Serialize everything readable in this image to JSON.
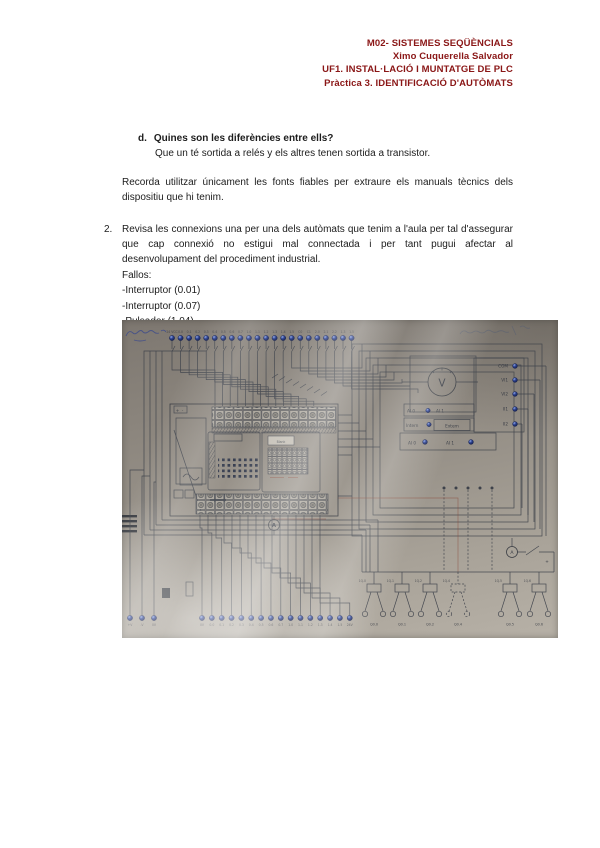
{
  "doc": {
    "header": {
      "lines": [
        "M02- SISTEMES SEQÜÈNCIALS",
        "Ximo Cuquerella Salvador",
        "UF1. INSTAL·LACIÓ I MUNTATGE DE PLC",
        "Pràctica 3. IDENTIFICACIÓ D'AUTÒMATS"
      ],
      "color": "#8a1616"
    },
    "item_d": {
      "label": "d.",
      "question": "Quines son les diferències entre ells?",
      "answer": "Que un té sortida a relés y els altres tenen sortida a transistor."
    },
    "note": "Recorda utilitzar únicament les fonts fiables per extraure els manuals tècnics dels dispositiu que hi tenim.",
    "item_2": {
      "label": "2.",
      "text": "Revisa les connexions una per una dels autòmats que tenim a l'aula per tal d'assegurar que cap connexió no estigui mal connectada i per tant pugui afectar al desenvolupament del procediment industrial.",
      "fallos_title": "Fallos:",
      "faults": [
        "-Interruptor (0.01)",
        "-Interruptor (0.07)",
        "-Pulsador (1.04)"
      ]
    }
  },
  "schematic": {
    "top_terminals": [
      "24 VCC",
      "0.0",
      "0.1",
      "0.2",
      "0.3",
      "0.4",
      "0.5",
      "0.6",
      "0.7",
      "1.0",
      "1.1",
      "1.2",
      "1.3",
      "1.4",
      "1.5",
      "C0",
      "C1",
      "2.0",
      "2.1",
      "2.2",
      "1.3",
      "1.5"
    ],
    "bottom_left_terminals": [
      "+V",
      "-V",
      "0V"
    ],
    "bottom_terminals": [
      "0V",
      "0.0",
      "0.1",
      "0.2",
      "0.3",
      "0.4",
      "0.5",
      "0.6",
      "0.7",
      "1.0",
      "1.1",
      "1.2",
      "1.3",
      "1.4",
      "1.5",
      "24V"
    ],
    "right_terminals": [
      "COM",
      "VI1",
      "VI2",
      "II1",
      "II2"
    ],
    "analog": {
      "row1_left": "AI 0",
      "row1_right": "AI 1",
      "row2_left": "Intern",
      "row2_right": "Extern",
      "row3_left": "AI 0",
      "row3_right": "AI 1"
    },
    "voltmeter_label": "V",
    "ammeter_label": "A",
    "plc": {
      "power_plus": "+",
      "power_minus": "-",
      "display": "Blank"
    },
    "relays": {
      "coil_labels": [
        "1Q.0",
        "1Q.1",
        "1Q.2",
        "1Q.4",
        "1Q.5",
        "1Q.6"
      ],
      "contact_labels": [
        "Q0.0",
        "Q0.1",
        "Q0.2",
        "Q0.4",
        "Q0.5",
        "Q0.6"
      ],
      "switch_plus": "+"
    },
    "colors": {
      "ink": "#3d414a",
      "terminal_blue": "#2a3f8e",
      "red_wire": "#8a4a3a",
      "pen_blue": "#3b4a8c",
      "header_red": "#8a1616"
    }
  }
}
